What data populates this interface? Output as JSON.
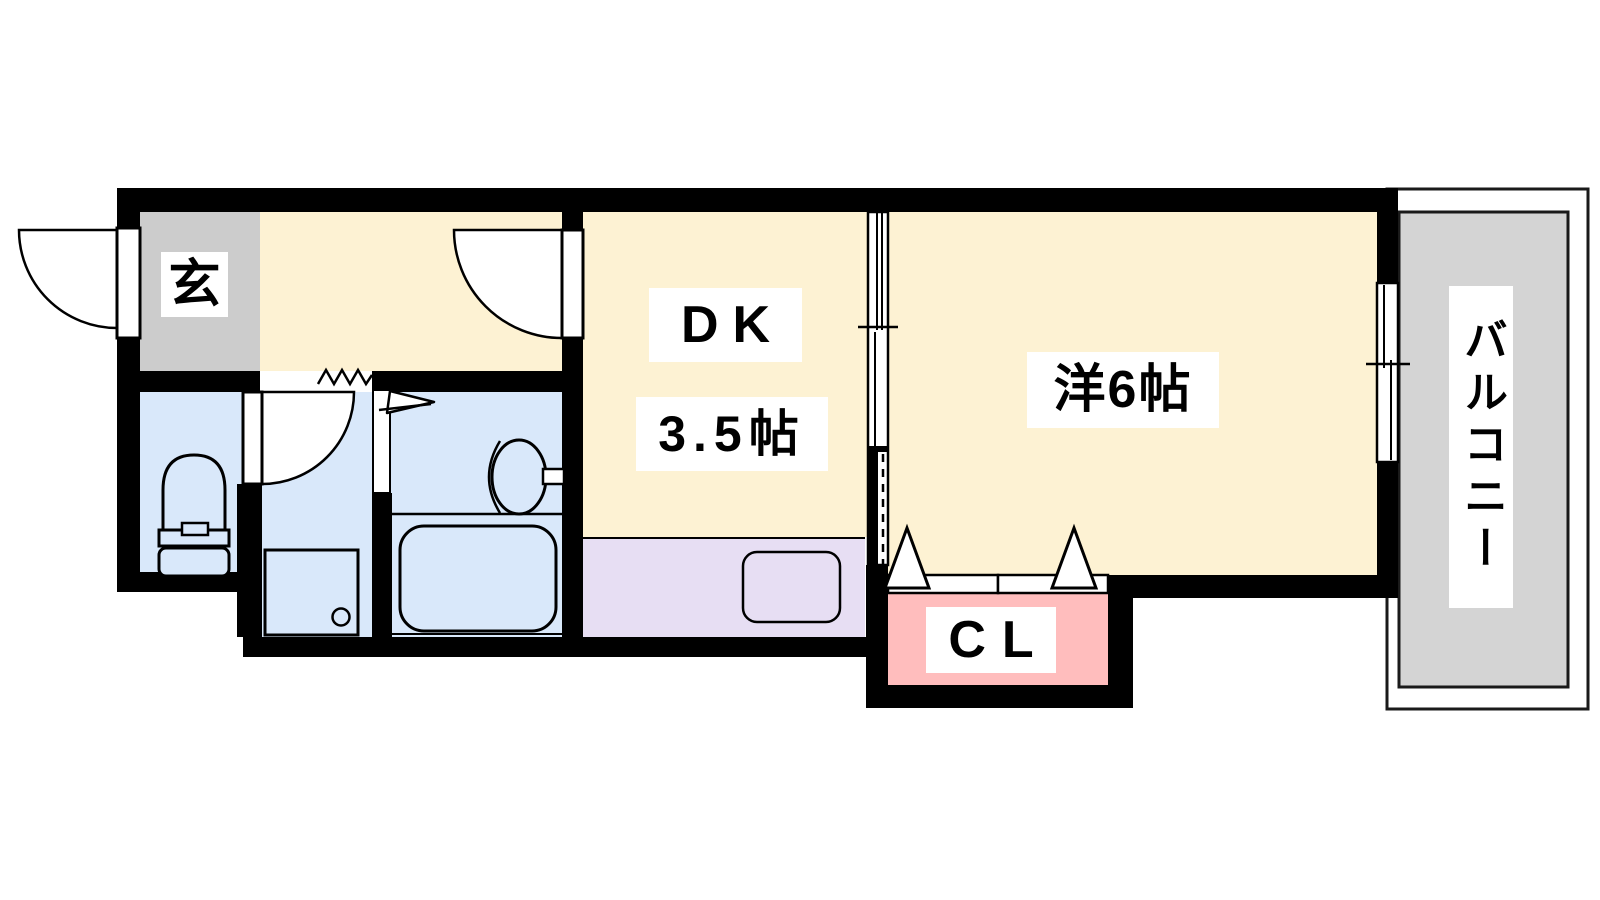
{
  "plan": {
    "rooms": {
      "genkan": {
        "label": "玄"
      },
      "dining_kitchen": {
        "label": "DK",
        "size_label": "3.5帖"
      },
      "western_room": {
        "label": "洋6帖"
      },
      "closet": {
        "label": "CL"
      },
      "balcony": {
        "label": "バルコニー"
      }
    },
    "fixtures": [
      "toilet",
      "washing-machine-pan",
      "wash-basin",
      "bathtub",
      "kitchen-sink",
      "entrance-door",
      "hall-door",
      "washroom-door",
      "bath-doorway",
      "sliding-partition",
      "balcony-window",
      "closet-folding-doors",
      "step-zigzag",
      "door-swing-flag"
    ],
    "colors": {
      "wall": "#000000",
      "room_cream": "#fdf2d3",
      "water_blue": "#d9e8fa",
      "kitchen_purple": "#e7def3",
      "closet_pink": "#ffbdbd",
      "genkan_gray": "#cccccc",
      "balcony_gray": "#d4d4d4",
      "outline": "#000000",
      "label_bg": "#ffffff",
      "text": "#000000"
    }
  }
}
